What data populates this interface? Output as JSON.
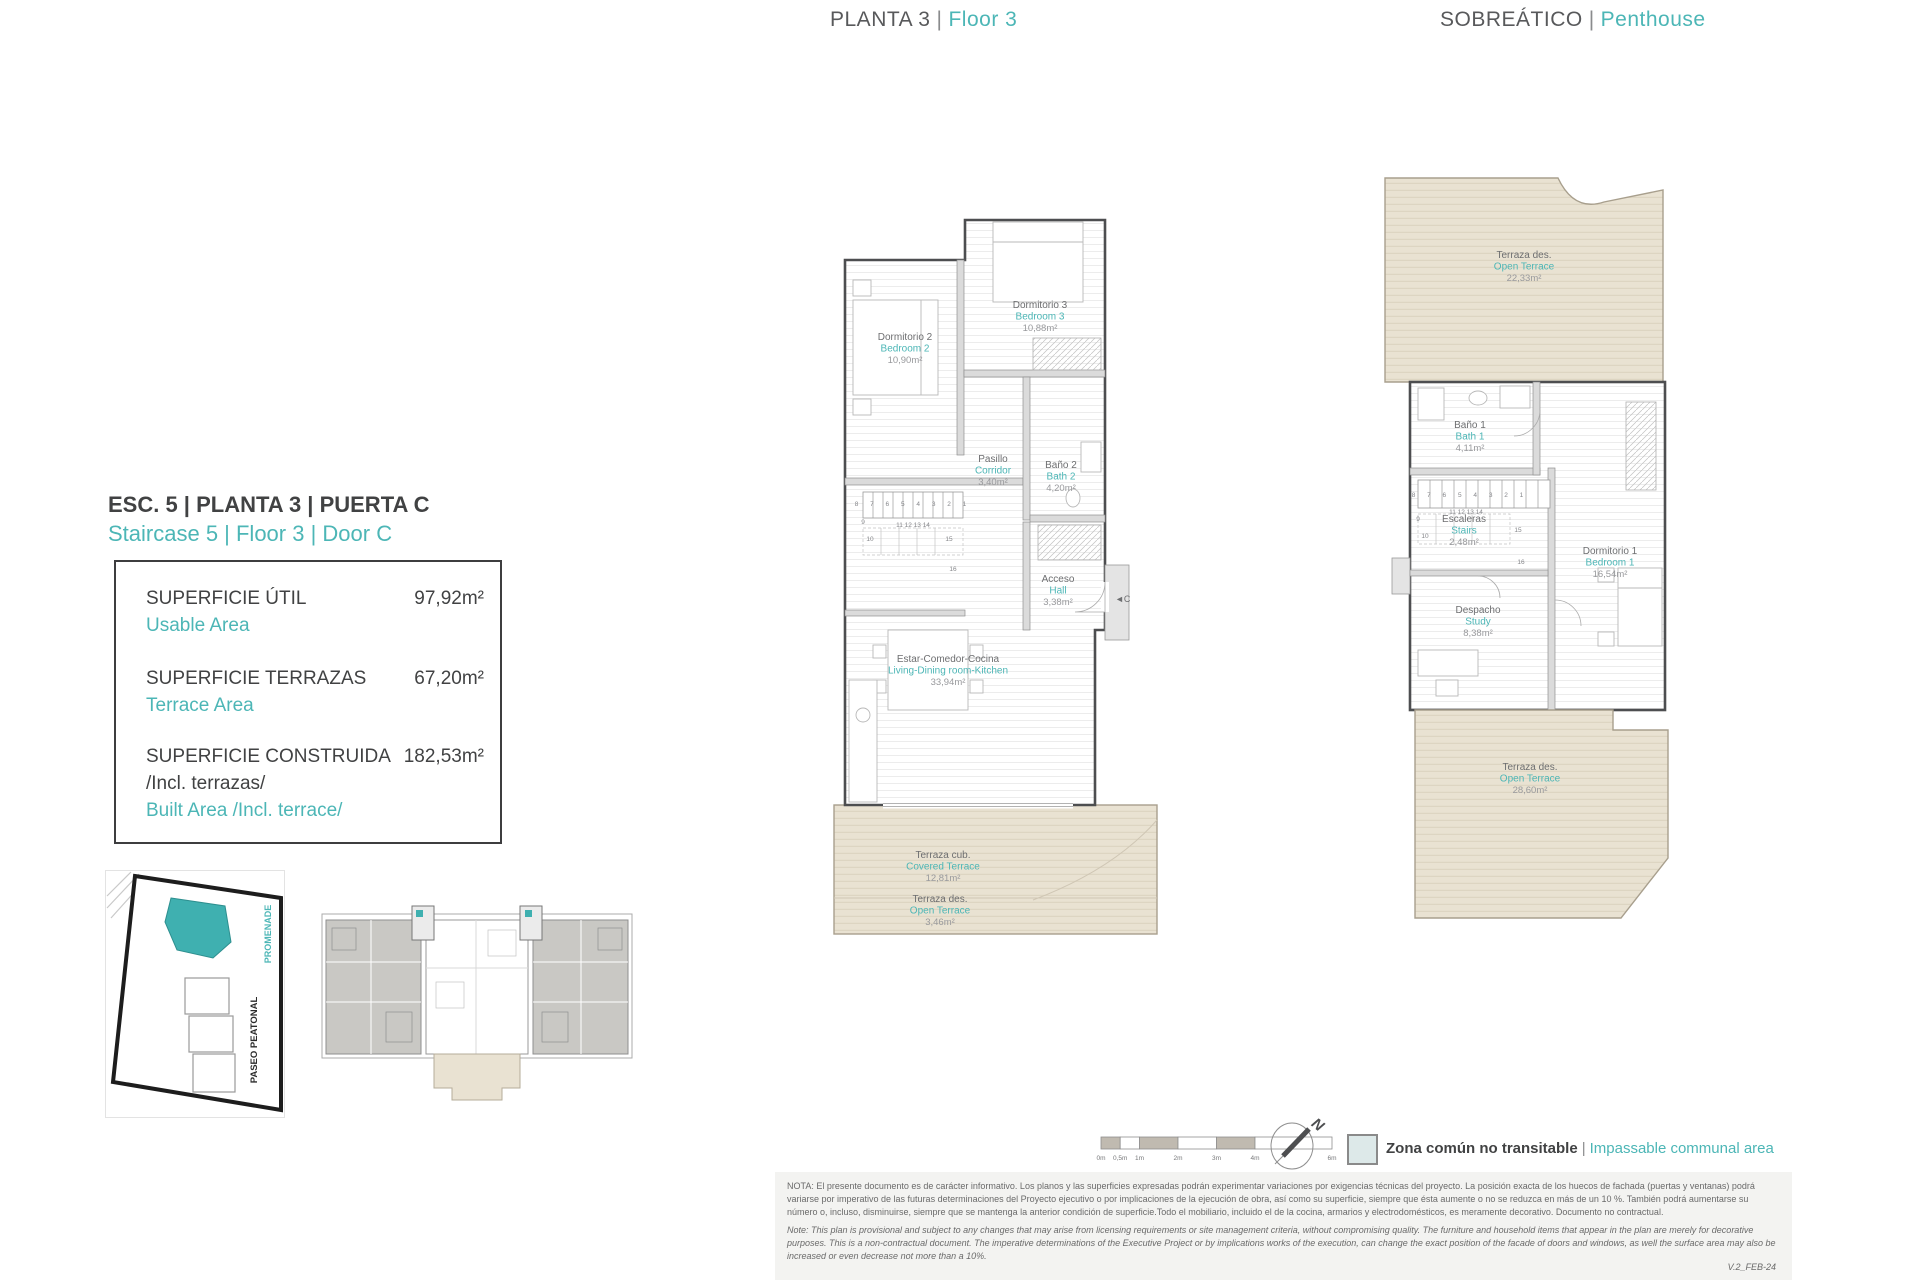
{
  "colors": {
    "teal_accent": "#4cb6b6",
    "gray_text": "#58595b",
    "terrace_fill": "#e9e2d2",
    "wall_fill": "#dbdbdb",
    "legend_swatch": "#dde9e9"
  },
  "titles": {
    "center": {
      "es": "PLANTA 3",
      "sep": "|",
      "en": "Floor 3"
    },
    "right": {
      "es": "SOBREÁTICO",
      "sep": "|",
      "en": "Penthouse"
    }
  },
  "unit": {
    "heading_es": "ESC. 5 | PLANTA 3 | PUERTA C",
    "heading_en": "Staircase 5 | Floor 3 | Door C",
    "rows": [
      {
        "label_es": "SUPERFICIE ÚTIL",
        "label_en": "Usable Area",
        "value": "97,92m²"
      },
      {
        "label_es": "SUPERFICIE TERRAZAS",
        "label_en": "Terrace Area",
        "value": "67,20m²"
      },
      {
        "label_es": "SUPERFICIE CONSTRUIDA",
        "label_es2": "/Incl. terrazas/",
        "label_en": "Built Area /Incl. terrace/",
        "value": "182,53m²"
      }
    ]
  },
  "siteplan": {
    "promenade": "PROMENADE",
    "paseo": "PASEO PEATONAL"
  },
  "plan_floor3": {
    "rooms": [
      {
        "es": "Dormitorio 2",
        "en": "Bedroom 2",
        "area": "10,90m²"
      },
      {
        "es": "Dormitorio 3",
        "en": "Bedroom 3",
        "area": "10,88m²"
      },
      {
        "es": "Pasillo",
        "en": "Corridor",
        "area": "3,40m²"
      },
      {
        "es": "Baño 2",
        "en": "Bath 2",
        "area": "4,20m²"
      },
      {
        "es": "Acceso",
        "en": "Hall",
        "area": "3,38m²"
      },
      {
        "es": "Estar-Comedor-Cocina",
        "en": "Living-Dining room-Kitchen",
        "area": "33,94m²"
      },
      {
        "es": "Terraza cub.",
        "en": "Covered Terrace",
        "area": "12,81m²"
      },
      {
        "es": "Terraza des.",
        "en": "Open Terrace",
        "area": "3,46m²"
      }
    ],
    "door_marker": "◄C",
    "stair_numbers": [
      "8 7 6 5 4 3 2 1",
      "9",
      "10",
      "11 12 13 14",
      "15",
      "16"
    ]
  },
  "plan_penthouse": {
    "rooms": [
      {
        "es": "Terraza des.",
        "en": "Open Terrace",
        "area": "22,33m²"
      },
      {
        "es": "Baño 1",
        "en": "Bath 1",
        "area": "4,11m²"
      },
      {
        "es": "Escaleras",
        "en": "Stairs",
        "area": "2,48m²"
      },
      {
        "es": "Dormitorio 1",
        "en": "Bedroom 1",
        "area": "16,54m²"
      },
      {
        "es": "Despacho",
        "en": "Study",
        "area": "8,38m²"
      },
      {
        "es": "Terraza des.",
        "en": "Open Terrace",
        "area": "28,60m²"
      }
    ],
    "stair_numbers": [
      "8 7 6 5 4 3 2 1",
      "9",
      "10",
      "11 12 13 14",
      "15",
      "16"
    ]
  },
  "scale_bar": {
    "labels": [
      "0m",
      "0,5m",
      "1m",
      "2m",
      "3m",
      "4m",
      "6m"
    ]
  },
  "compass": {
    "n": "N"
  },
  "legend": {
    "es": "Zona común no transitable",
    "sep": "|",
    "en": "Impassable communal area"
  },
  "disclaimer": {
    "nota": "NOTA:  El presente documento es de carácter informativo. Los planos y las superficies expresadas podrán experimentar variaciones por exigencias técnicas del proyecto. La posición exacta de los huecos de fachada (puertas y ventanas) podrá variarse por imperativo de las futuras determinaciones del Proyecto ejecutivo o por implicaciones de la ejecución de obra, así como su superficie, siempre que ésta aumente o no se reduzca en más de un 10 %. También podrá aumentarse su número o, incluso, disminuirse, siempre que se mantenga la anterior condición de superficie.Todo el mobiliario, incluido el de la cocina, armarios y electrodomésticos, es meramente decorativo. Documento no contractual.",
    "note": "Note: This plan is provisional and subject to any changes that may arise from licensing requirements or site management criteria, without compromising quality. The furniture and household items that appear in the plan are merely for decorative purposes. This is a non-contractual document. The imperative determinations of the Executive Project or by implications works of the execution, can change the exact position of the facade of doors and windows, as well the surface area may also be increased or even decrease not more than a 10%.",
    "version": "V.2_FEB-24"
  }
}
